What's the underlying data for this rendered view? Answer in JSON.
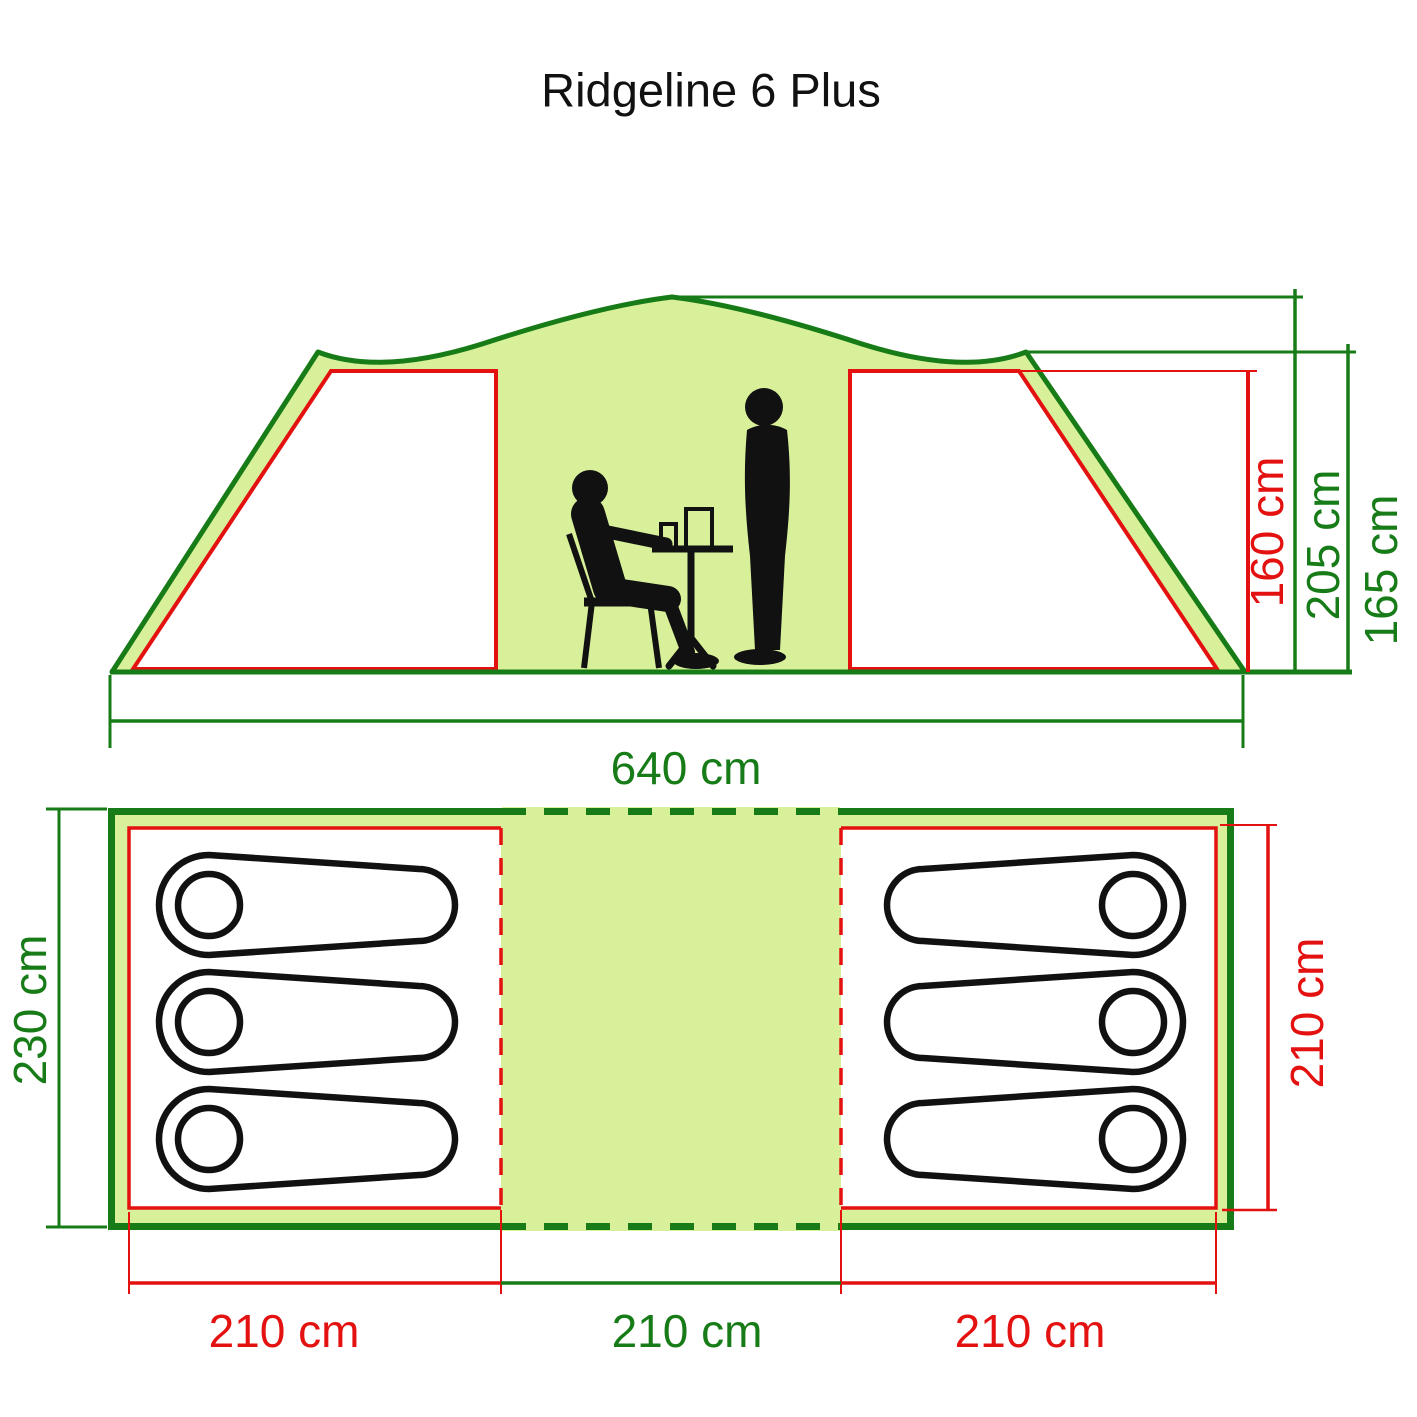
{
  "title": "Ridgeline 6 Plus",
  "colors": {
    "line_green": "#177c17",
    "fill_light_green": "#d9f09a",
    "dimension_red": "#e41111",
    "figure_black": "#111111",
    "cabin_white": "#ffffff",
    "background": "#ffffff"
  },
  "elevation": {
    "peak_height_label": "205 cm",
    "side_height_label": "165 cm",
    "inner_height_label": "160 cm",
    "total_width_label": "640 cm"
  },
  "floor_plan": {
    "total_depth_label": "230 cm",
    "cabin_depth_label": "210 cm",
    "left_cabin_width_label": "210 cm",
    "living_area_width_label": "210 cm",
    "right_cabin_width_label": "210 cm",
    "sleeping_bags_left": 3,
    "sleeping_bags_right": 3
  }
}
